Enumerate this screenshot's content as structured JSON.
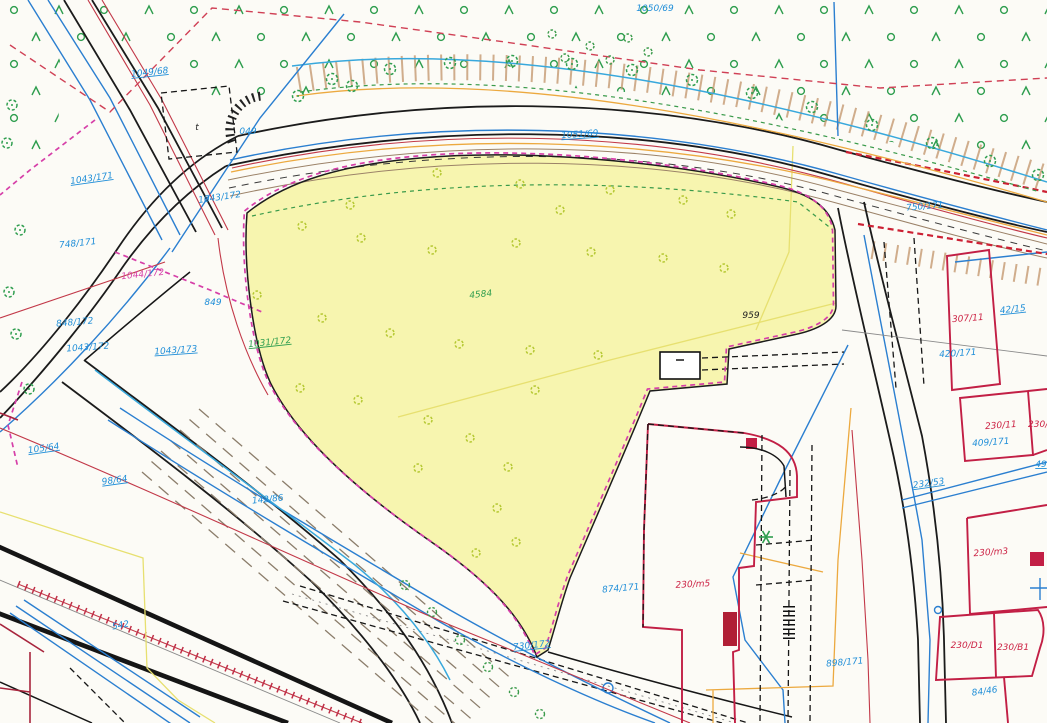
{
  "meta": {
    "kind": "scanned cadastral site plan",
    "width_px": 1047,
    "height_px": 723
  },
  "colors": {
    "highlight_parcel_fill": "#f6f3a2",
    "parcel_boundary_magenta": "#d63fa8",
    "building_parcel_red": "#c21f45",
    "utility_blue": "#2b7fd0",
    "water_cyan": "#38a8dc",
    "utility_red": "#c23848",
    "utility_orange": "#eca93f",
    "vegetation_green": "#2f9e4f",
    "bush_yellow_green": "#b5c832",
    "label_blue": "#1f8ed8",
    "label_red": "#cc2244"
  },
  "parcel_labels": [
    {
      "text": "1050/69",
      "x": 655,
      "y": 11,
      "color": "blue"
    },
    {
      "text": "1049/68",
      "x": 150,
      "y": 75,
      "color": "blue",
      "underline": true,
      "rot": -6
    },
    {
      "text": "1043/171",
      "x": 92,
      "y": 181,
      "color": "blue",
      "underline": true,
      "rot": -8
    },
    {
      "text": "1043/172",
      "x": 220,
      "y": 200,
      "color": "blue",
      "rot": -8
    },
    {
      "text": "1051/69",
      "x": 580,
      "y": 137,
      "color": "blue",
      "underline": true,
      "rot": -4
    },
    {
      "text": "748/171",
      "x": 78,
      "y": 246,
      "color": "blue",
      "rot": -6
    },
    {
      "text": "1044/172",
      "x": 143,
      "y": 277,
      "color": "magenta",
      "rot": -6
    },
    {
      "text": "049",
      "x": 248,
      "y": 134,
      "color": "blue"
    },
    {
      "text": "849",
      "x": 213,
      "y": 305,
      "color": "blue"
    },
    {
      "text": "848/172",
      "x": 75,
      "y": 325,
      "color": "blue",
      "rot": -5
    },
    {
      "text": "1043/172",
      "x": 88,
      "y": 350,
      "color": "blue",
      "rot": -4
    },
    {
      "text": "1043/173",
      "x": 176,
      "y": 353,
      "color": "blue",
      "underline": true,
      "rot": -4
    },
    {
      "text": "1031/172",
      "x": 270,
      "y": 345,
      "color": "green",
      "underline": true,
      "rot": -6
    },
    {
      "text": "105/64",
      "x": 44,
      "y": 451,
      "color": "blue",
      "underline": true,
      "rot": -8
    },
    {
      "text": "98/64",
      "x": 115,
      "y": 483,
      "color": "blue",
      "underline": true,
      "rot": -8
    },
    {
      "text": "142/86",
      "x": 268,
      "y": 502,
      "color": "blue",
      "rot": -6
    },
    {
      "text": "542",
      "x": 121,
      "y": 628,
      "color": "blue",
      "rot": -10
    },
    {
      "text": "730/172",
      "x": 532,
      "y": 648,
      "color": "blue",
      "underline": true,
      "rot": -6
    },
    {
      "text": "4584",
      "x": 481,
      "y": 297,
      "color": "green",
      "rot": -6
    },
    {
      "text": "959",
      "x": 751,
      "y": 318,
      "color": "black"
    },
    {
      "text": "750/171",
      "x": 925,
      "y": 209,
      "color": "blue",
      "rot": -5
    },
    {
      "text": "307/11",
      "x": 968,
      "y": 321,
      "color": "red",
      "rot": -4
    },
    {
      "text": "420/171",
      "x": 958,
      "y": 356,
      "color": "blue",
      "rot": -4
    },
    {
      "text": "42/15",
      "x": 1013,
      "y": 312,
      "color": "blue",
      "underline": true,
      "rot": -6
    },
    {
      "text": "230/11",
      "x": 1001,
      "y": 428,
      "color": "red",
      "rot": -4
    },
    {
      "text": "409/171",
      "x": 991,
      "y": 445,
      "color": "blue",
      "rot": -4
    },
    {
      "text": "230/1",
      "x": 1041,
      "y": 427,
      "color": "red"
    },
    {
      "text": "49",
      "x": 1041,
      "y": 467,
      "color": "blue",
      "underline": true
    },
    {
      "text": "232/53",
      "x": 929,
      "y": 486,
      "color": "blue",
      "underline": true,
      "rot": -8
    },
    {
      "text": "230/m3",
      "x": 991,
      "y": 555,
      "color": "red",
      "rot": -4
    },
    {
      "text": "230/D1",
      "x": 967,
      "y": 648,
      "color": "red"
    },
    {
      "text": "230/B1",
      "x": 1013,
      "y": 650,
      "color": "red"
    },
    {
      "text": "84/46",
      "x": 985,
      "y": 694,
      "color": "blue",
      "rot": -8
    },
    {
      "text": "230/m5",
      "x": 693,
      "y": 587,
      "color": "red",
      "rot": -3
    },
    {
      "text": "874/171",
      "x": 621,
      "y": 591,
      "color": "blue",
      "rot": -5
    },
    {
      "text": "898/171",
      "x": 845,
      "y": 665,
      "color": "blue",
      "rot": -5
    },
    {
      "text": "t",
      "x": 197,
      "y": 130,
      "color": "black"
    }
  ],
  "map_features": {
    "tree_grid": {
      "x0": 14,
      "y0": 10,
      "dx": 45,
      "dy": 27,
      "cols": 24,
      "rows": 6,
      "row_offset": 22
    },
    "bushes_in_parcel": [
      [
        437,
        173
      ],
      [
        520,
        184
      ],
      [
        610,
        190
      ],
      [
        683,
        200
      ],
      [
        731,
        214
      ],
      [
        302,
        226
      ],
      [
        361,
        238
      ],
      [
        432,
        250
      ],
      [
        516,
        243
      ],
      [
        591,
        252
      ],
      [
        663,
        258
      ],
      [
        724,
        268
      ],
      [
        257,
        295
      ],
      [
        322,
        318
      ],
      [
        390,
        333
      ],
      [
        459,
        344
      ],
      [
        530,
        350
      ],
      [
        598,
        355
      ],
      [
        300,
        388
      ],
      [
        358,
        400
      ],
      [
        428,
        420
      ],
      [
        470,
        438
      ],
      [
        508,
        467
      ],
      [
        497,
        508
      ],
      [
        516,
        542
      ],
      [
        476,
        553
      ],
      [
        418,
        468
      ],
      [
        350,
        205
      ],
      [
        560,
        210
      ],
      [
        535,
        390
      ]
    ],
    "trees_roadside": [
      [
        332,
        79
      ],
      [
        390,
        69
      ],
      [
        450,
        63
      ],
      [
        512,
        61
      ],
      [
        572,
        64
      ],
      [
        632,
        70
      ],
      [
        692,
        80
      ],
      [
        752,
        93
      ],
      [
        812,
        107
      ],
      [
        872,
        125
      ],
      [
        932,
        143
      ],
      [
        990,
        161
      ],
      [
        1038,
        175
      ],
      [
        298,
        96
      ],
      [
        352,
        86
      ]
    ],
    "trees_left_edge": [
      [
        12,
        105
      ],
      [
        7,
        143
      ],
      [
        20,
        230
      ],
      [
        9,
        292
      ],
      [
        16,
        334
      ],
      [
        29,
        389
      ]
    ],
    "trees_bottom_diagonal": [
      [
        405,
        585
      ],
      [
        432,
        612
      ],
      [
        460,
        640
      ],
      [
        488,
        667
      ],
      [
        514,
        692
      ],
      [
        540,
        714
      ]
    ],
    "trees_cluster": [
      [
        552,
        34
      ],
      [
        590,
        46
      ],
      [
        628,
        38
      ],
      [
        565,
        58
      ],
      [
        610,
        60
      ],
      [
        648,
        52
      ]
    ],
    "conifer_star": [
      [
        766,
        537
      ]
    ]
  }
}
